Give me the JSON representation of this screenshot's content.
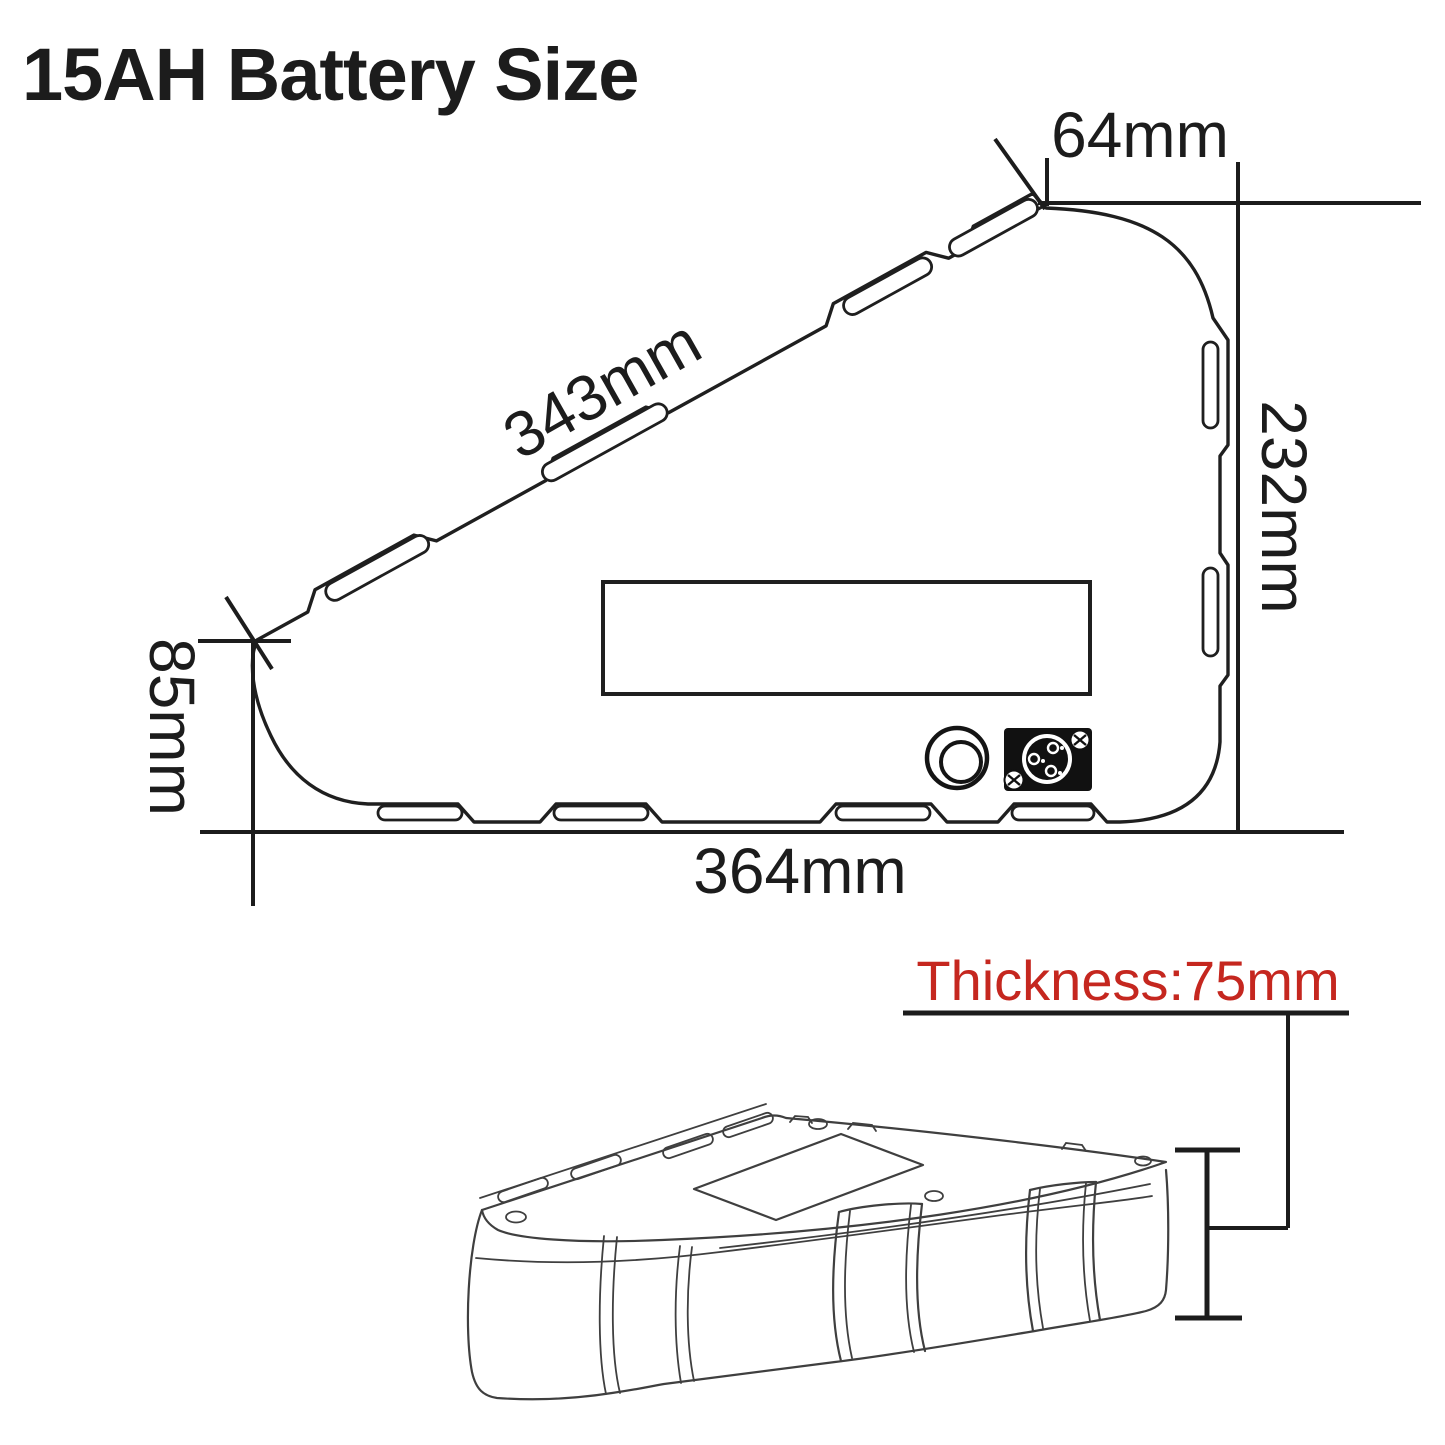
{
  "title": "15AH Battery Size",
  "colors": {
    "ink": "#1c1c1c",
    "sketch": "#3f3f3f",
    "red": "#c5271f",
    "background": "#ffffff"
  },
  "dimensions": {
    "top_width": "64mm",
    "slant_length": "343mm",
    "right_height": "232mm",
    "left_height": "85mm",
    "bottom_width": "364mm",
    "thickness": "Thickness:75mm"
  },
  "views": {
    "side_view": "triangle battery side profile with mounting slots, charge port and power connector",
    "iso_view": "triangle battery 3D perspective view with thickness gauge"
  },
  "icons": {
    "charge_port": "round charging socket (two concentric circles)",
    "power_connector": "3-pin power connector plate with corner screws"
  }
}
